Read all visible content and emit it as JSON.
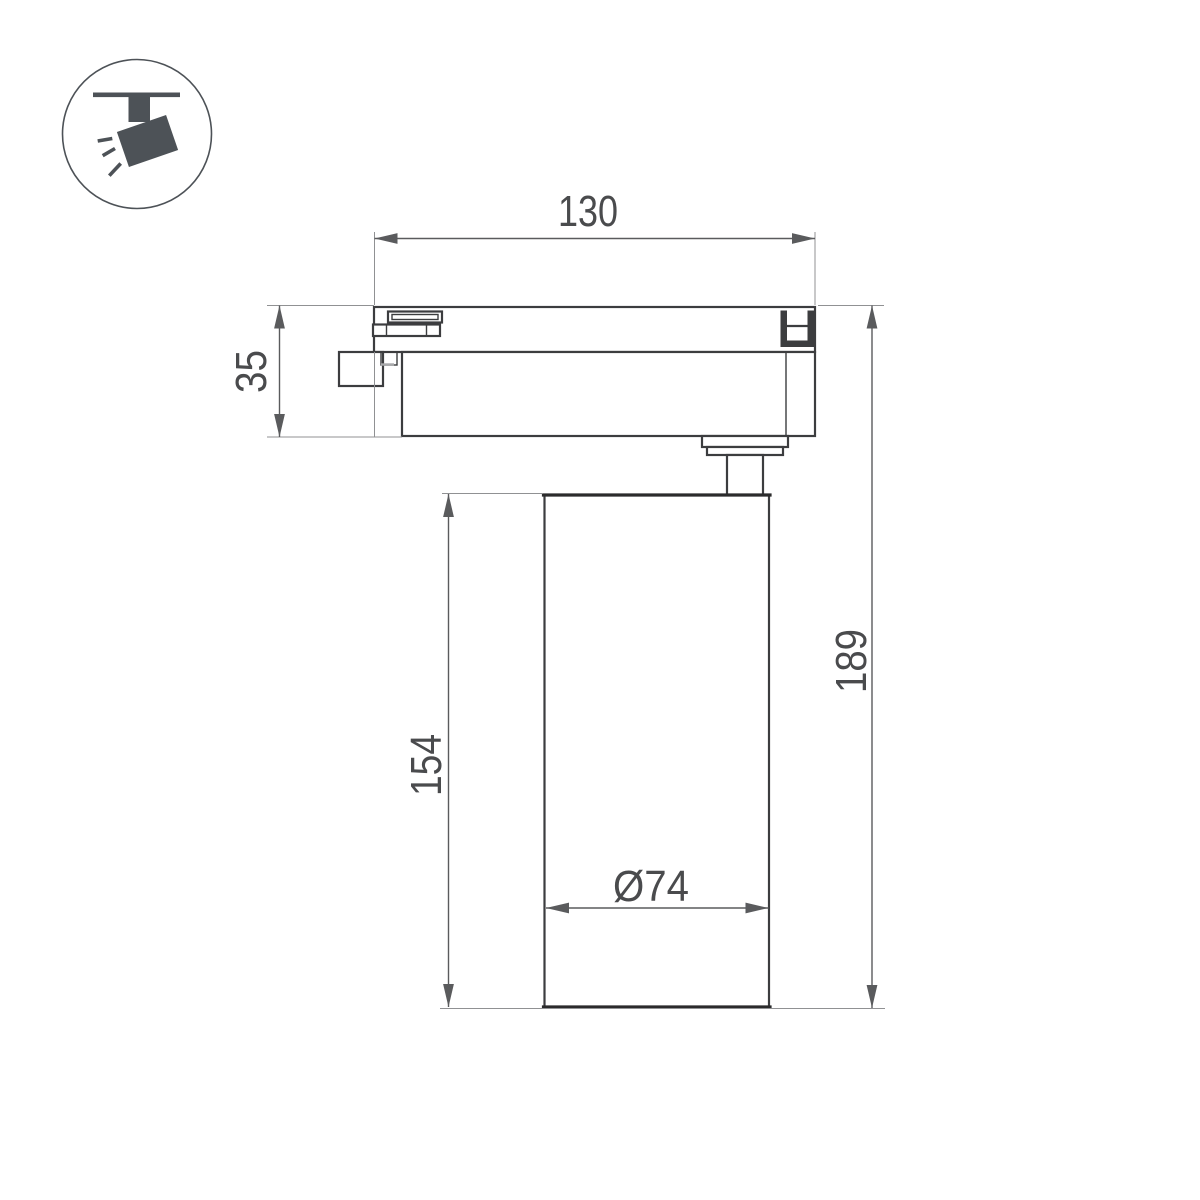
{
  "document": {
    "type": "technical-dimension-drawing",
    "subject": "track-mounted spotlight luminaire, side view"
  },
  "colors": {
    "page-bg": "#ffffff",
    "object-line": "#3c3d3f",
    "thick-line": "#2b2b2c",
    "dim-line": "#5a5b5d",
    "ext-line": "#909193",
    "text-color": "#4a4b4d",
    "accent-gray": "#a8a9ab",
    "icon-color": "#4d5257"
  },
  "icon": {
    "name": "track-spotlight-pictogram"
  },
  "dimensions": {
    "track_width": {
      "value": "130",
      "unit": "mm",
      "measures": "track adapter length"
    },
    "adapter_height": {
      "value": "35",
      "unit": "mm",
      "measures": "track adapter height"
    },
    "body_height": {
      "value": "154",
      "unit": "mm",
      "measures": "lamp cylinder height"
    },
    "total_height": {
      "value": "189",
      "unit": "mm",
      "measures": "overall height"
    },
    "diameter": {
      "value": "Ø74",
      "unit": "mm",
      "measures": "cylinder diameter"
    }
  }
}
